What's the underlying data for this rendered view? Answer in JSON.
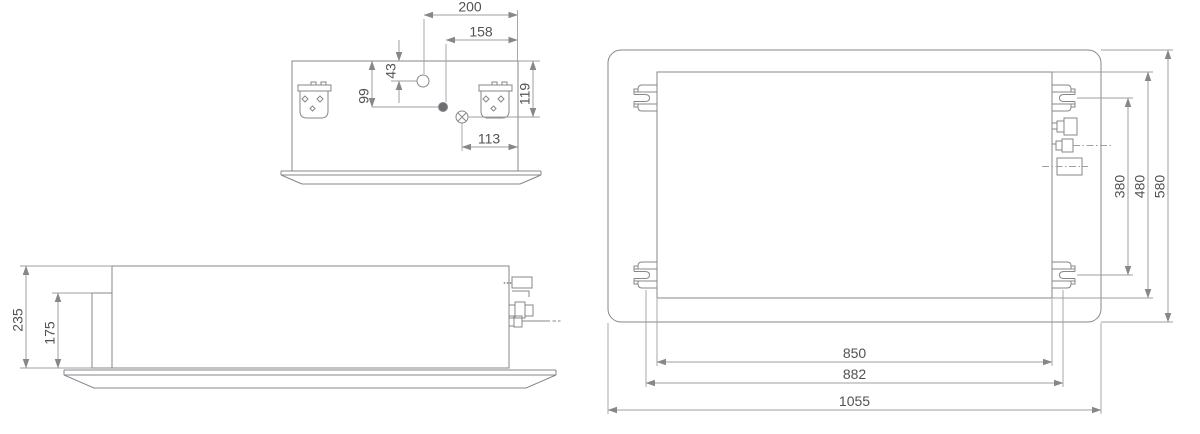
{
  "end_view": {
    "dim_200": "200",
    "dim_158": "158",
    "dim_43": "43",
    "dim_99": "99",
    "dim_119": "119",
    "dim_113": "113"
  },
  "side_view": {
    "dim_235": "235",
    "dim_175": "175"
  },
  "plan_view": {
    "dim_380": "380",
    "dim_480": "480",
    "dim_580": "580",
    "dim_850": "850",
    "dim_882": "882",
    "dim_1055": "1055"
  },
  "colors": {
    "object_line": "#85878a",
    "dimension_line": "#9d9fa2",
    "text": "#515254",
    "arrow": "#85878a",
    "hole_fill": "#6d6e71",
    "background": "#ffffff"
  }
}
